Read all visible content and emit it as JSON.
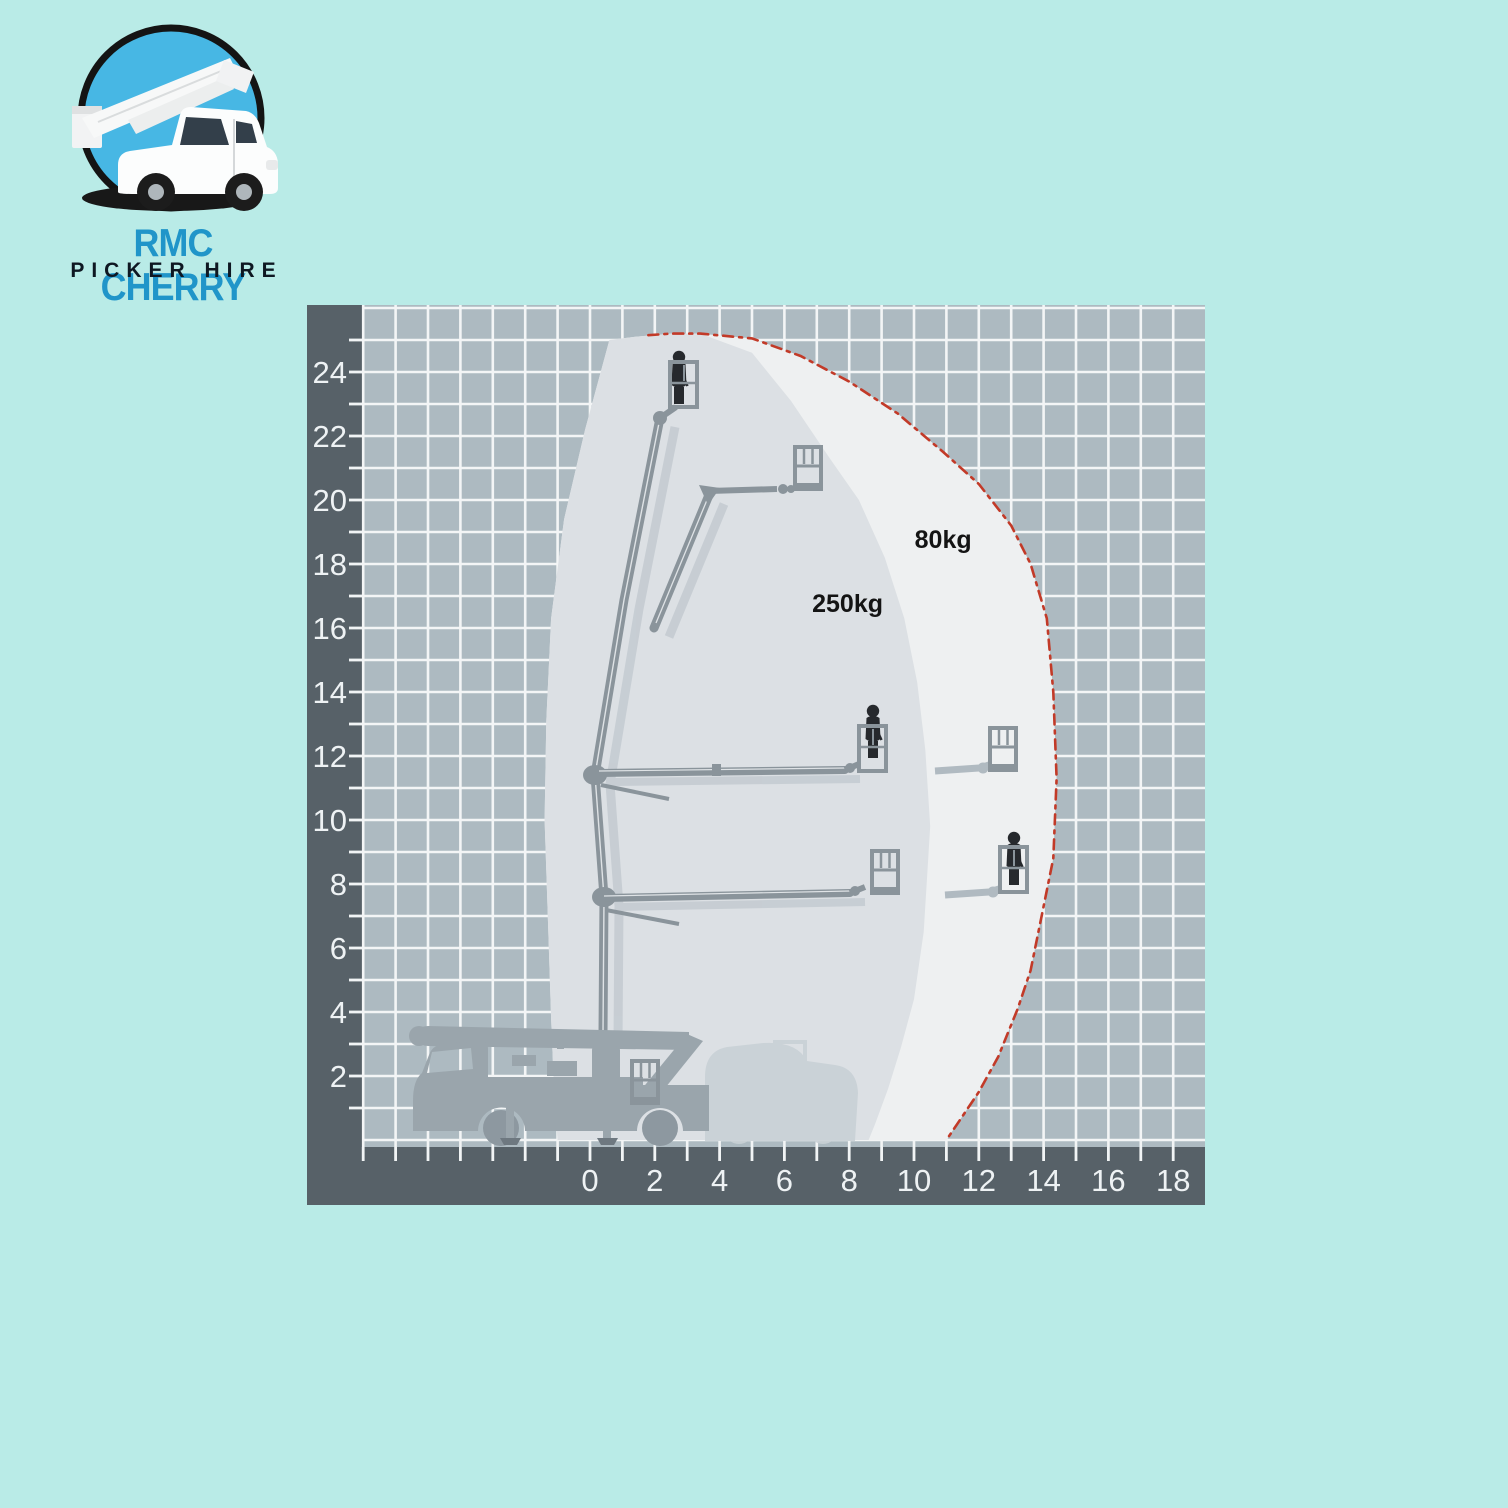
{
  "page": {
    "background_color": "#b9ebe7"
  },
  "logo": {
    "title": "RMC CHERRY",
    "subtitle": "PICKER HIRE",
    "title_color": "#2095c9",
    "subtitle_color": "#0e1722",
    "badge_fill": "#47b7e4",
    "badge_ring": "#141414"
  },
  "diagram": {
    "axis_band_color": "#576168",
    "grid_fill": "#adbac1",
    "grid_line_color": "#f3f5f6",
    "tick_color": "#f1f4f5",
    "zone_250_color": "#dce0e4",
    "zone_80_color": "#eef0f1",
    "boundary_color": "#c23a28",
    "silhouette_color": "#8a949b",
    "shadow_color": "#b6bfc6",
    "truck_color": "#9aa5ac",
    "ghost_color": "#c9d1d6",
    "person_color": "#26292d"
  },
  "chart_data": {
    "type": "area",
    "title": "Cherry picker working envelope (outreach m vs working height m)",
    "xlabel": "",
    "ylabel": "",
    "grid": true,
    "xlim": [
      -7,
      18.2
    ],
    "ylim": [
      0,
      26.1
    ],
    "x_ticks": [
      0,
      2,
      4,
      6,
      8,
      10,
      12,
      14,
      16,
      18
    ],
    "y_ticks": [
      2,
      4,
      6,
      8,
      10,
      12,
      14,
      16,
      18,
      20,
      22,
      24
    ],
    "zones": [
      {
        "name": "80kg zone",
        "fill_key": "zone_80_color",
        "points": [
          [
            -1.0,
            0
          ],
          [
            -1.1,
            1.3
          ],
          [
            -1.2,
            3.8
          ],
          [
            -1.3,
            6.9
          ],
          [
            -1.4,
            10.0
          ],
          [
            -1.35,
            13.1
          ],
          [
            -1.2,
            16.3
          ],
          [
            -0.8,
            19.4
          ],
          [
            -0.15,
            22.2
          ],
          [
            0.6,
            25.0
          ],
          [
            1.4,
            25.1
          ],
          [
            2.5,
            25.2
          ],
          [
            3.4,
            25.2
          ],
          [
            5.0,
            25.05
          ],
          [
            6.5,
            24.5
          ],
          [
            8.0,
            23.7
          ],
          [
            9.5,
            22.7
          ],
          [
            10.9,
            21.5
          ],
          [
            12.0,
            20.5
          ],
          [
            13.0,
            19.2
          ],
          [
            13.6,
            18.0
          ],
          [
            14.1,
            16.3
          ],
          [
            14.3,
            14.0
          ],
          [
            14.4,
            11.3
          ],
          [
            14.3,
            8.8
          ],
          [
            14.0,
            7.3
          ],
          [
            13.6,
            5.3
          ],
          [
            13.2,
            4.1
          ],
          [
            12.6,
            2.6
          ],
          [
            12.0,
            1.5
          ],
          [
            11.4,
            0.6
          ],
          [
            11.0,
            0
          ]
        ]
      },
      {
        "name": "250kg zone",
        "fill_key": "zone_250_color",
        "points": [
          [
            -1.0,
            0
          ],
          [
            -1.1,
            1.3
          ],
          [
            -1.2,
            3.8
          ],
          [
            -1.3,
            6.9
          ],
          [
            -1.4,
            10.0
          ],
          [
            -1.35,
            13.1
          ],
          [
            -1.2,
            16.3
          ],
          [
            -0.8,
            19.4
          ],
          [
            -0.15,
            22.2
          ],
          [
            0.6,
            25.0
          ],
          [
            1.4,
            25.1
          ],
          [
            2.5,
            25.2
          ],
          [
            3.4,
            25.2
          ],
          [
            5.0,
            24.6
          ],
          [
            6.2,
            23.1
          ],
          [
            7.4,
            21.3
          ],
          [
            8.3,
            20.0
          ],
          [
            9.1,
            18.2
          ],
          [
            9.7,
            16.3
          ],
          [
            10.1,
            14.3
          ],
          [
            10.35,
            12.2
          ],
          [
            10.5,
            9.8
          ],
          [
            10.3,
            6.5
          ],
          [
            10.0,
            4.4
          ],
          [
            9.6,
            2.9
          ],
          [
            9.2,
            1.6
          ],
          [
            8.8,
            0.5
          ],
          [
            8.6,
            0
          ]
        ]
      }
    ],
    "boundary": {
      "name": "80kg limit",
      "style": "dash-dot",
      "points": [
        [
          1.8,
          25.15
        ],
        [
          2.5,
          25.2
        ],
        [
          3.4,
          25.2
        ],
        [
          5.0,
          25.05
        ],
        [
          6.5,
          24.5
        ],
        [
          8.0,
          23.7
        ],
        [
          9.5,
          22.7
        ],
        [
          10.9,
          21.5
        ],
        [
          12.0,
          20.5
        ],
        [
          13.0,
          19.2
        ],
        [
          13.6,
          18.0
        ],
        [
          14.1,
          16.3
        ],
        [
          14.3,
          14.0
        ],
        [
          14.4,
          11.3
        ],
        [
          14.3,
          8.8
        ],
        [
          14.0,
          7.3
        ],
        [
          13.6,
          5.3
        ],
        [
          13.2,
          4.1
        ],
        [
          12.6,
          2.6
        ],
        [
          12.0,
          1.5
        ],
        [
          11.4,
          0.6
        ],
        [
          11.0,
          0
        ]
      ]
    },
    "annotations": [
      {
        "id": "load-label-80kg",
        "text": "80kg",
        "x": 10.9,
        "y": 18.5
      },
      {
        "id": "load-label-250kg",
        "text": "250kg",
        "x": 7.95,
        "y": 16.5
      }
    ]
  }
}
